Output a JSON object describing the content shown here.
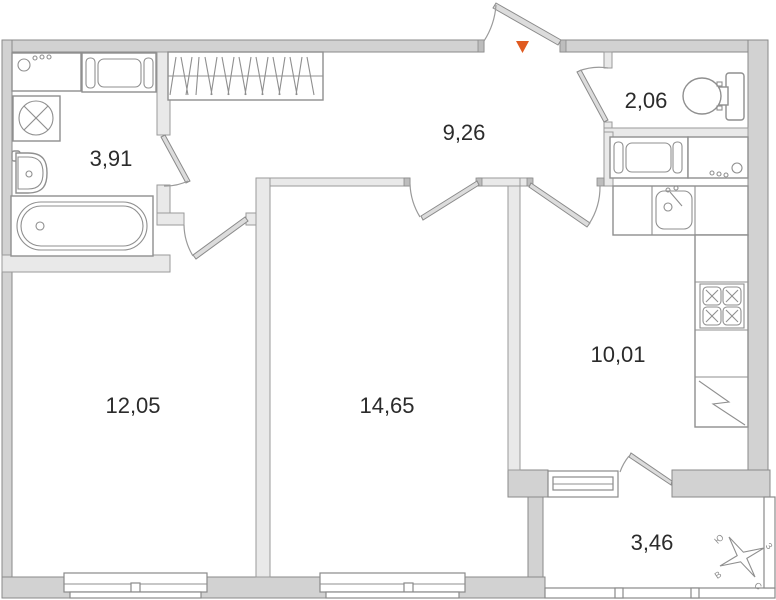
{
  "plan": {
    "type": "apartment-floor-plan",
    "rooms": [
      {
        "id": "bathroom",
        "area_label": "3,91"
      },
      {
        "id": "hallway",
        "area_label": "9,26"
      },
      {
        "id": "wc",
        "area_label": "2,06"
      },
      {
        "id": "living-room",
        "area_label": "12,05"
      },
      {
        "id": "bedroom",
        "area_label": "14,65"
      },
      {
        "id": "kitchen",
        "area_label": "10,01"
      },
      {
        "id": "balcony",
        "area_label": "3,46"
      }
    ],
    "entrance_marker": {
      "shape": "triangle-down",
      "color": "#e05a20"
    },
    "compass": {
      "top_left": "Ю",
      "top_right": "З",
      "bottom_left": "В",
      "bottom_right": "С"
    },
    "fixtures": [
      "washing-machine",
      "laundry-appliance",
      "washer-with-cross",
      "wash-basin",
      "bathtub",
      "wardrobe-hatching",
      "toilet",
      "kitchen-washing-machine",
      "kitchen-counter",
      "kitchen-sink",
      "stove-4-burner",
      "refrigerator",
      "windows",
      "entrance-door"
    ],
    "colors": {
      "exterior_wall": "#d2d2d2",
      "interior_wall": "#e9e9e9",
      "wall_stroke": "#8a8a8a",
      "label_text": "#2b2b2b",
      "background": "#ffffff"
    }
  }
}
